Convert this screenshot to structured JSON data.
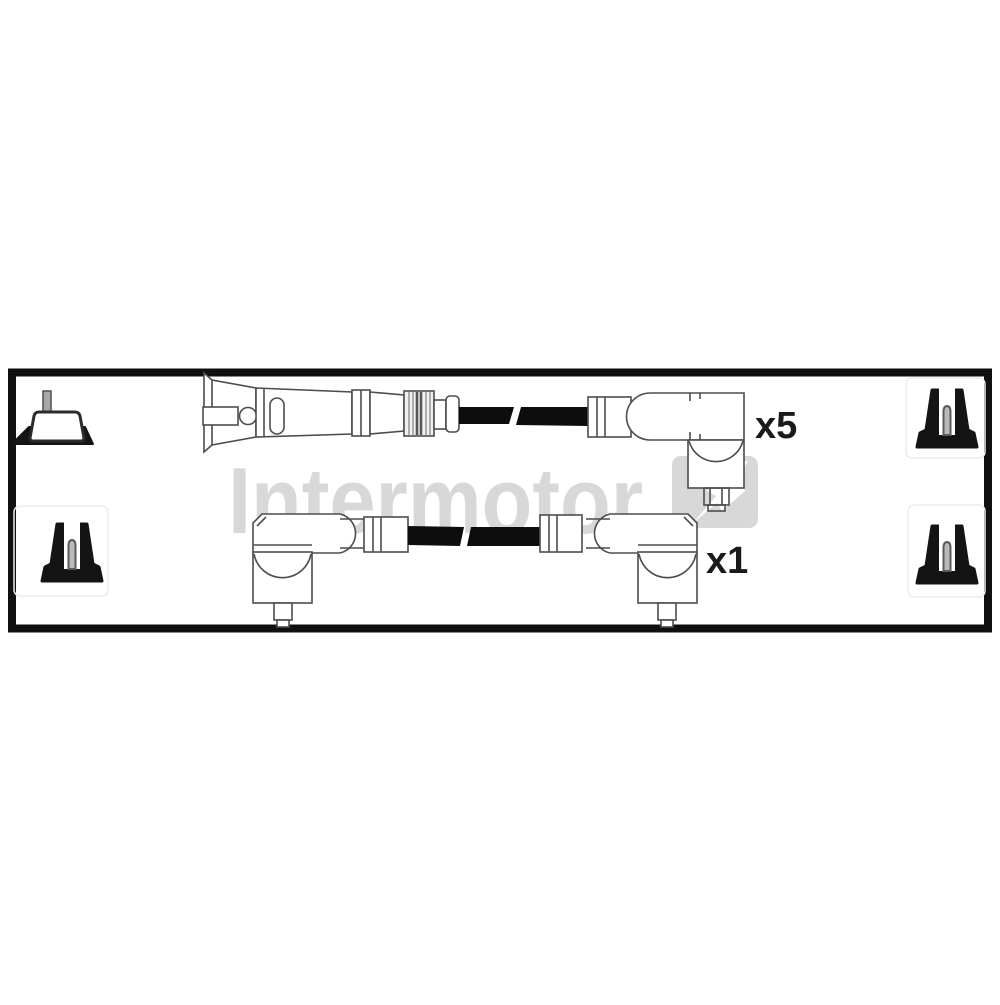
{
  "image": {
    "background_color": "#ffffff",
    "frame_border_color": "#101010",
    "line_color": "#4d4d4d",
    "cable_color": "#0d0d0d",
    "label_color": "#1a1a1a"
  },
  "watermark": {
    "text": "Intermotor",
    "color": "#d8d8d8",
    "logo_icon": "lightning-bolt-logo"
  },
  "leads": {
    "top": {
      "qty_label": "x5"
    },
    "bottom": {
      "qty_label": "x1"
    }
  },
  "corner_icons": {
    "top_left": "din-stud-terminal-icon",
    "top_right": "screw-terminal-icon",
    "bottom_left": "screw-terminal-icon",
    "bottom_right": "screw-terminal-icon"
  }
}
